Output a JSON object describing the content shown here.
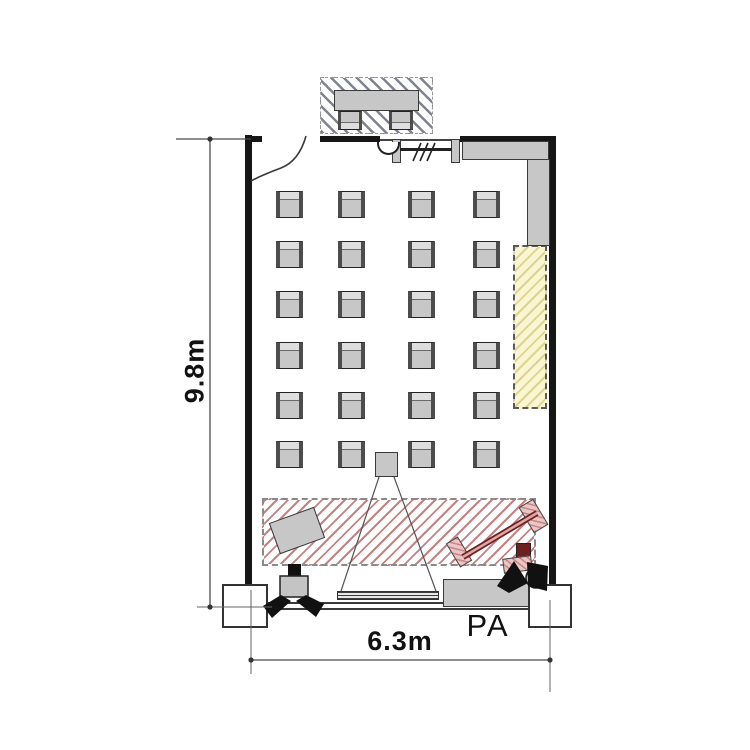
{
  "floor_plan": {
    "dimension_labels": {
      "height": "9.8m",
      "width": "6.3m"
    },
    "annotations": {
      "pa_label": "PA"
    },
    "seating": {
      "rows": 6,
      "columns": 4,
      "total_chairs": 24
    },
    "booth": {
      "chairs": 2
    },
    "fixture_icons": [
      "entrance-door-icon",
      "control-booth-icon",
      "observation-window-icon",
      "wall-counter-icon",
      "storage-area-icon",
      "stage-area-icon",
      "projector-icon",
      "projection-screen-icon",
      "keyboard-stand-icon",
      "stage-monitor-left-icon",
      "stage-monitor-right-icon",
      "pa-table-icon",
      "column-footing-icon"
    ]
  },
  "colors": {
    "wall": "#161616",
    "furniture-fill": "#c7c7c7",
    "furniture-edge": "#3a3a3a",
    "storage-fill": "#faf6d2",
    "stage-hatch": "#b25858",
    "booth-hatch": "#696e7d",
    "keyboard-dark": "#6e1f1f",
    "keyboard-pink": "#e4b6b6",
    "dim-line": "#4a4a4a",
    "text": "#111111"
  }
}
